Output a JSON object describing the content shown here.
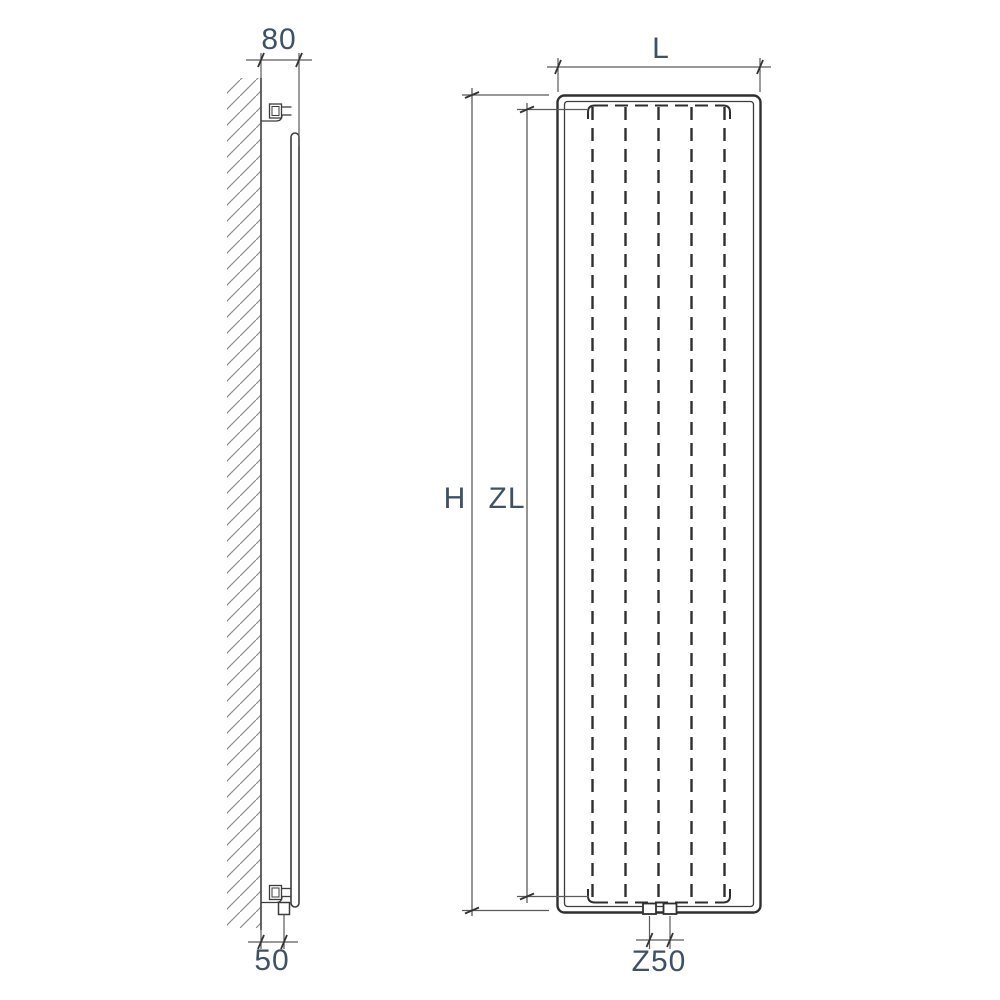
{
  "drawing": {
    "kind": "radiator technical dimension drawing",
    "views": {
      "side_view": "wall-mounted side profile with brackets and bottom valve",
      "front_view": "front elevation with dashed hidden heating channels"
    },
    "front_view": {
      "channel_count": 5,
      "connection_port_count": 2
    }
  },
  "labels": {
    "depth": "80",
    "wall_clearance": "50",
    "width": "L",
    "height": "H",
    "inner_height": "ZL",
    "connection_spacing": "Z50"
  },
  "colors": {
    "background": "#ffffff",
    "outline": "#2f2f2f",
    "line": "#3c3c3c",
    "dimension_line": "#5a5a5a",
    "tick": "#333333",
    "hatch": "#8f8f8f",
    "label_text": "#3f5166"
  }
}
